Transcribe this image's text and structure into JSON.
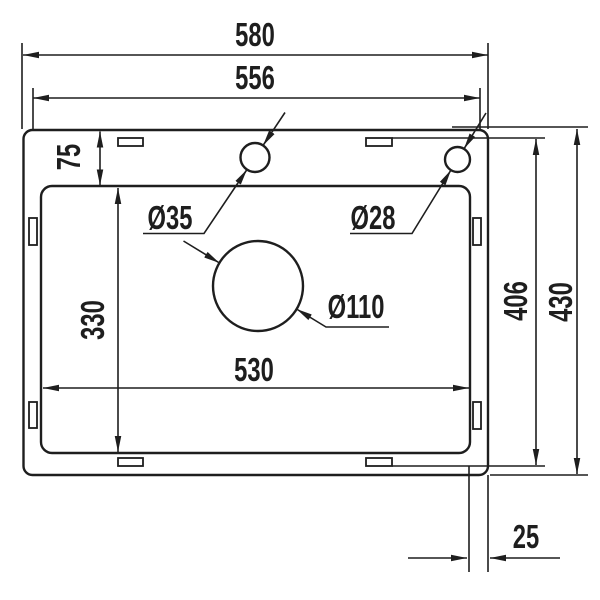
{
  "drawing": {
    "kind": "sink-dimension-drawing",
    "colors": {
      "line": "#1e1e1e",
      "background": "#ffffff"
    },
    "dimensions": {
      "overall_width": "580",
      "inner_rim_width": "556",
      "rim_top_offset": "75",
      "bowl_height": "330",
      "bowl_width": "530",
      "clip_span_height": "406",
      "overall_height": "430",
      "right_edge_offset": "25",
      "faucet_hole_diameter": "Ø35",
      "accessory_hole_diameter": "Ø28",
      "drain_hole_diameter": "Ø110"
    }
  }
}
